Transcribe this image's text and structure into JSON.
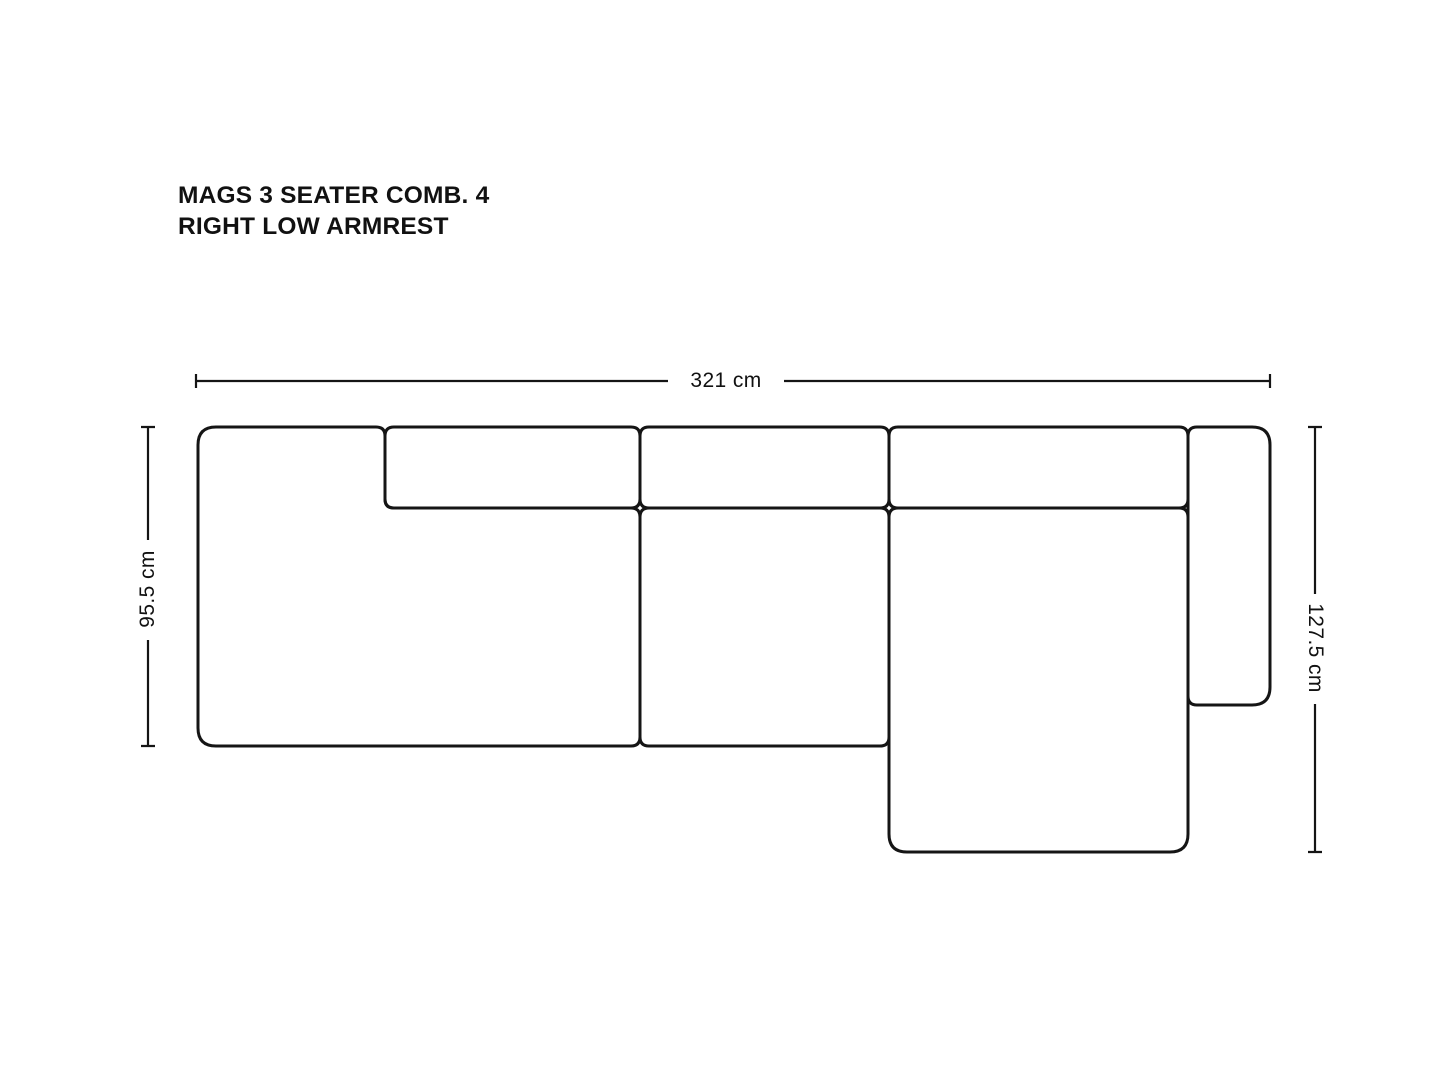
{
  "title": {
    "line1": "MAGS 3 SEATER COMB. 4",
    "line2": "RIGHT LOW ARMREST"
  },
  "dimensions": {
    "overall_width": "321 cm",
    "seat_depth": "95.5 cm",
    "chaise_depth": "127.5 cm"
  },
  "drawing": {
    "line_color": "#151515",
    "background": "#ffffff",
    "view": "top view plan drawing",
    "modules": [
      "left lounge module with low armrest",
      "left backrest cushion",
      "middle backrest cushion",
      "middle seat cushion",
      "chaise backrest cushion",
      "chaise longue seat",
      "right low armrest"
    ]
  }
}
